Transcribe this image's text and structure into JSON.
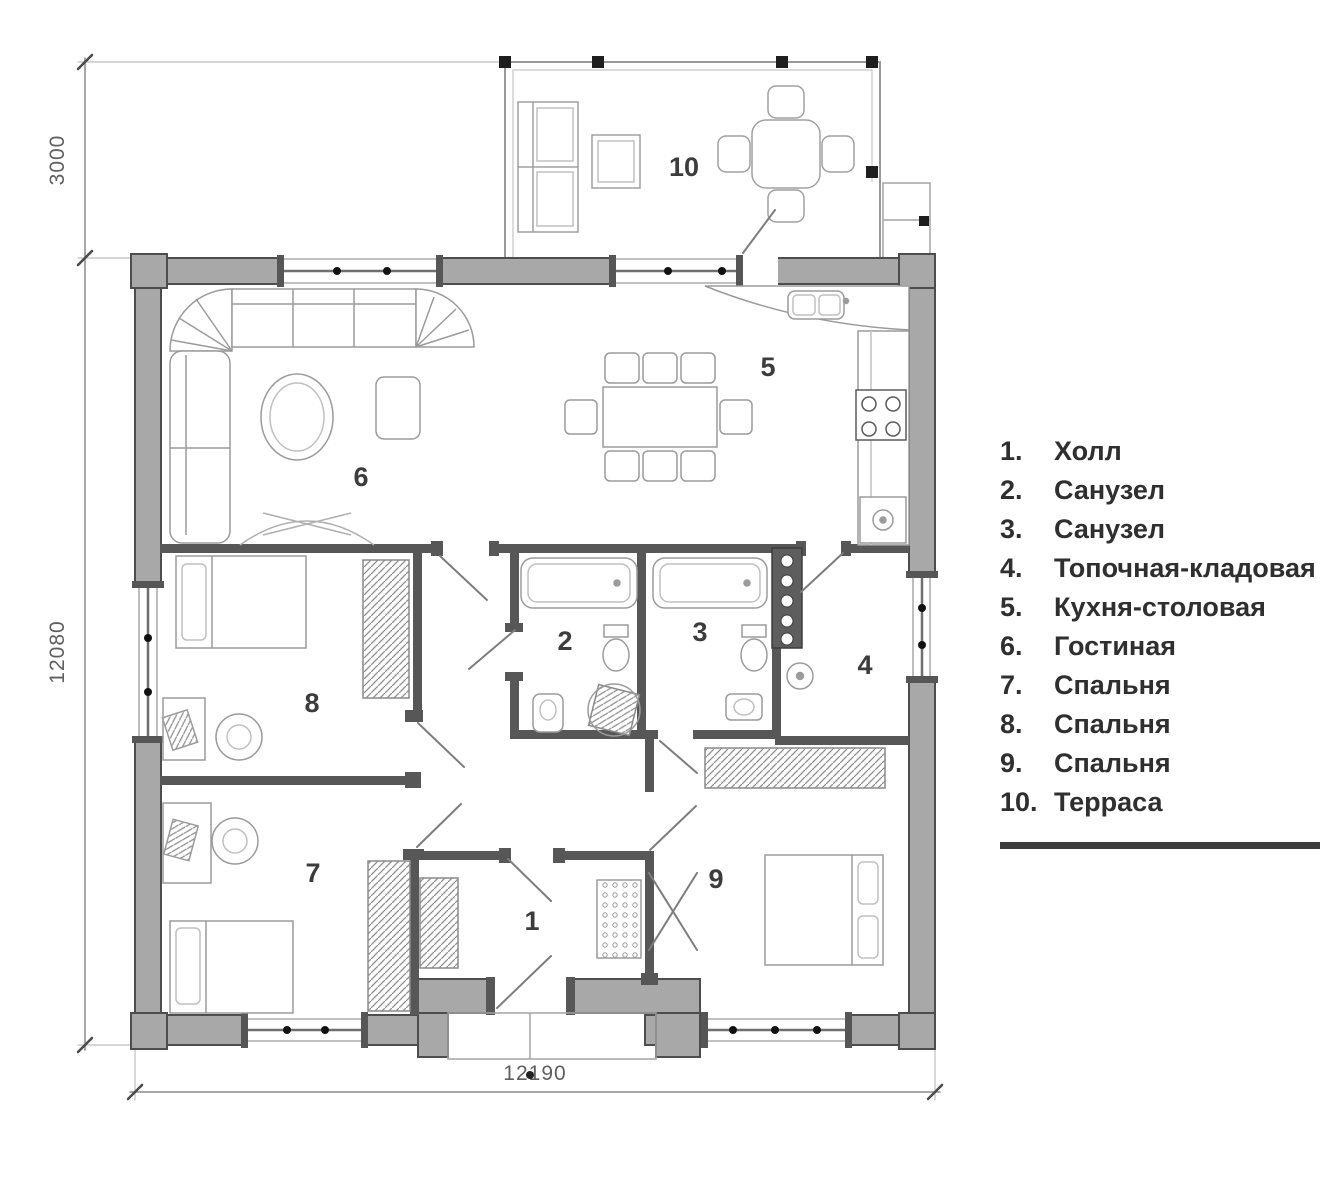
{
  "colors": {
    "wall_fill": "#a8a8a8",
    "wall_stroke": "#4d4d4d",
    "interior_wall": "#575757",
    "furniture_line": "#999999",
    "column_black": "#1e1e1e",
    "text": "#3c3c3c",
    "dim_text": "#5f5f5f"
  },
  "dimensions": {
    "terrace_depth": "3000",
    "house_depth": "12080",
    "house_width": "12190"
  },
  "rooms": [
    {
      "num": "1",
      "dot": "1.",
      "name": "Холл"
    },
    {
      "num": "2",
      "dot": "2.",
      "name": "Санузел"
    },
    {
      "num": "3",
      "dot": "3.",
      "name": "Санузел"
    },
    {
      "num": "4",
      "dot": "4.",
      "name": "Топочная-кладовая"
    },
    {
      "num": "5",
      "dot": "5.",
      "name": "Кухня-столовая"
    },
    {
      "num": "6",
      "dot": "6.",
      "name": "Гостиная"
    },
    {
      "num": "7",
      "dot": "7.",
      "name": "Спальня"
    },
    {
      "num": "8",
      "dot": "8.",
      "name": "Спальня"
    },
    {
      "num": "9",
      "dot": "9.",
      "name": "Спальня"
    },
    {
      "num": "10",
      "dot": "10.",
      "name": "Терраса"
    }
  ]
}
